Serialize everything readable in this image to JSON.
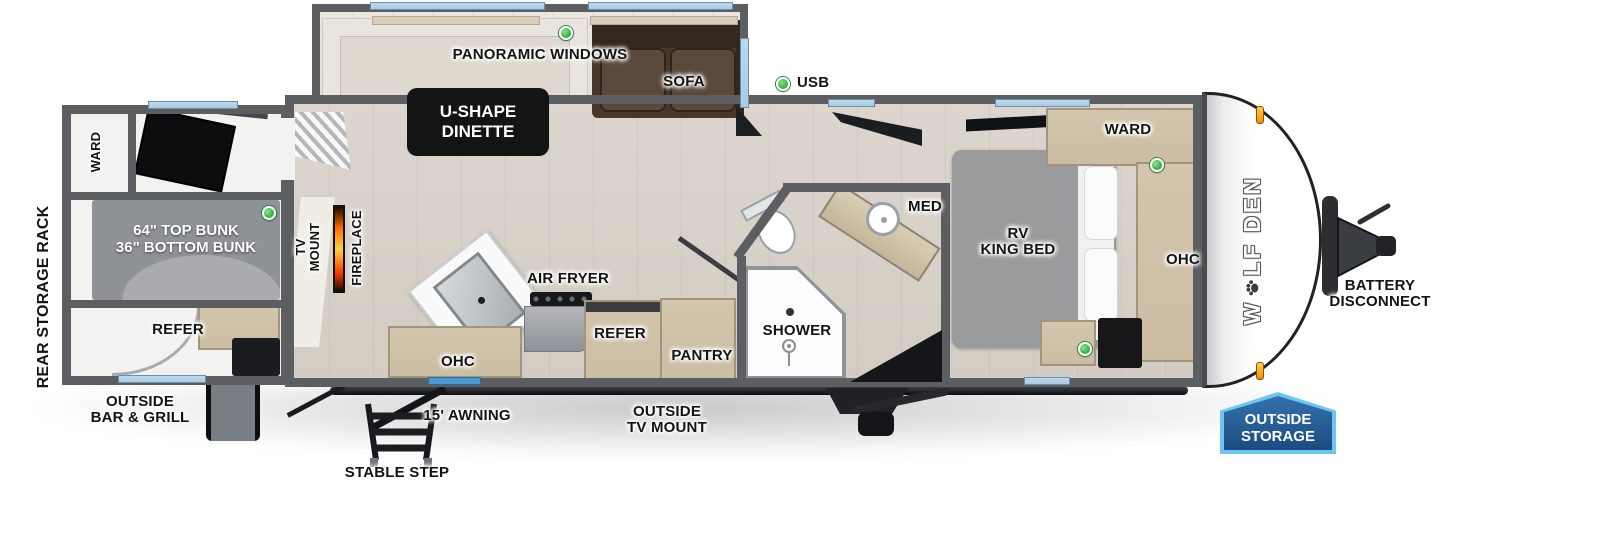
{
  "page": {
    "width": 1600,
    "height": 555,
    "background": "#ffffff"
  },
  "brand": {
    "name": "WOLF DEN",
    "part1": "W",
    "part2": "LF DEN",
    "paw_icon": "paw-print"
  },
  "colors": {
    "wall_gray": "#5c5e62",
    "window_blue": "#a9cbe4",
    "door_window_blue": "#4a9ad2",
    "led_green": "#3cb54a",
    "fireplace_orange": "#ff6a00",
    "cabinet_tan": "#cbbda3",
    "sofa_brown": "#46362b",
    "bed_gray": "#9b9b9d",
    "badge_border_blue": "#6ec6ef",
    "badge_blue": "#2e6ca8",
    "label_box_black": "#141414"
  },
  "labels": {
    "panoramic_windows": "PANORAMIC WINDOWS",
    "sofa": "SOFA",
    "usb": "USB",
    "u_shape_dinette": "U-SHAPE\nDINETTE",
    "ward_bedroom": "WARD",
    "med": "MED",
    "rv_king_bed": "RV\nKING BED",
    "ohc_bedroom": "OHC",
    "rear_storage_rack": "REAR STORAGE RACK",
    "ward_bunkroom": "WARD",
    "bunks": "64\" TOP BUNK\n36\" BOTTOM BUNK",
    "refer_bunkroom": "REFER",
    "tv_mount": "TV\nMOUNT",
    "fireplace": "FIREPLACE",
    "air_fryer": "AIR FRYER",
    "ohc_kitchen": "OHC",
    "refer_kitchen": "REFER",
    "pantry": "PANTRY",
    "shower": "SHOWER",
    "outside_bar_grill": "OUTSIDE\nBAR & GRILL",
    "stable_step": "STABLE STEP",
    "awning": "15' AWNING",
    "outside_tv_mount": "OUTSIDE\nTV MOUNT",
    "battery_disconnect": "BATTERY\nDISCONNECT",
    "outside_storage": "OUTSIDE\nSTORAGE"
  }
}
